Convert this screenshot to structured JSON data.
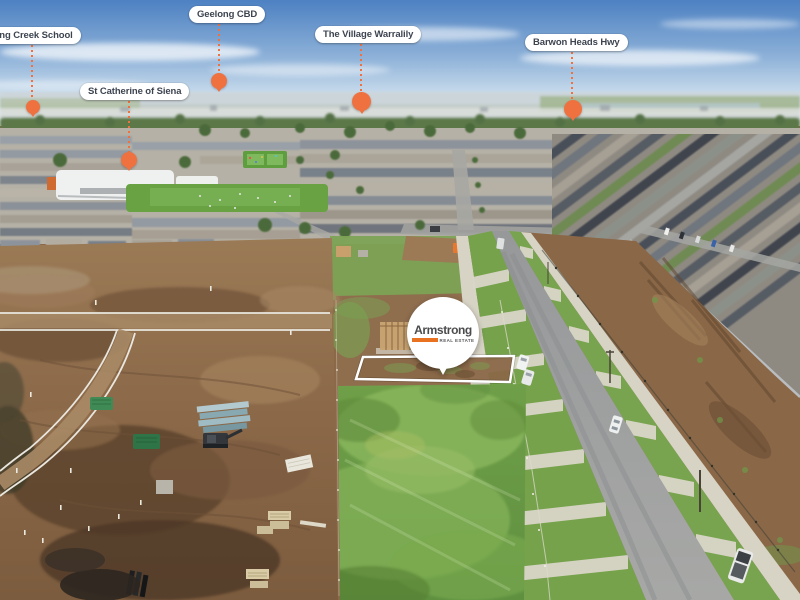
{
  "markers": [
    {
      "id": "armstrong-creek-school",
      "label": "Armstrong Creek School"
    },
    {
      "id": "geelong-cbd",
      "label": "Geelong CBD"
    },
    {
      "id": "st-catherine-of-siena",
      "label": "St Catherine of Siena"
    },
    {
      "id": "the-village-warralily",
      "label": "The Village Warralily"
    },
    {
      "id": "barwon-heads-hwy",
      "label": "Barwon Heads Hwy"
    }
  ],
  "property_pin": {
    "brand": "Armstrong",
    "tagline": "REAL ESTATE"
  },
  "colors": {
    "marker_orange": "#ef7140",
    "pill_background": "#ffffff",
    "pill_text": "#3d4450",
    "brand_text": "#4b4b4d",
    "brand_orange": "#e8721f",
    "lot_outline": "#ffffff"
  }
}
